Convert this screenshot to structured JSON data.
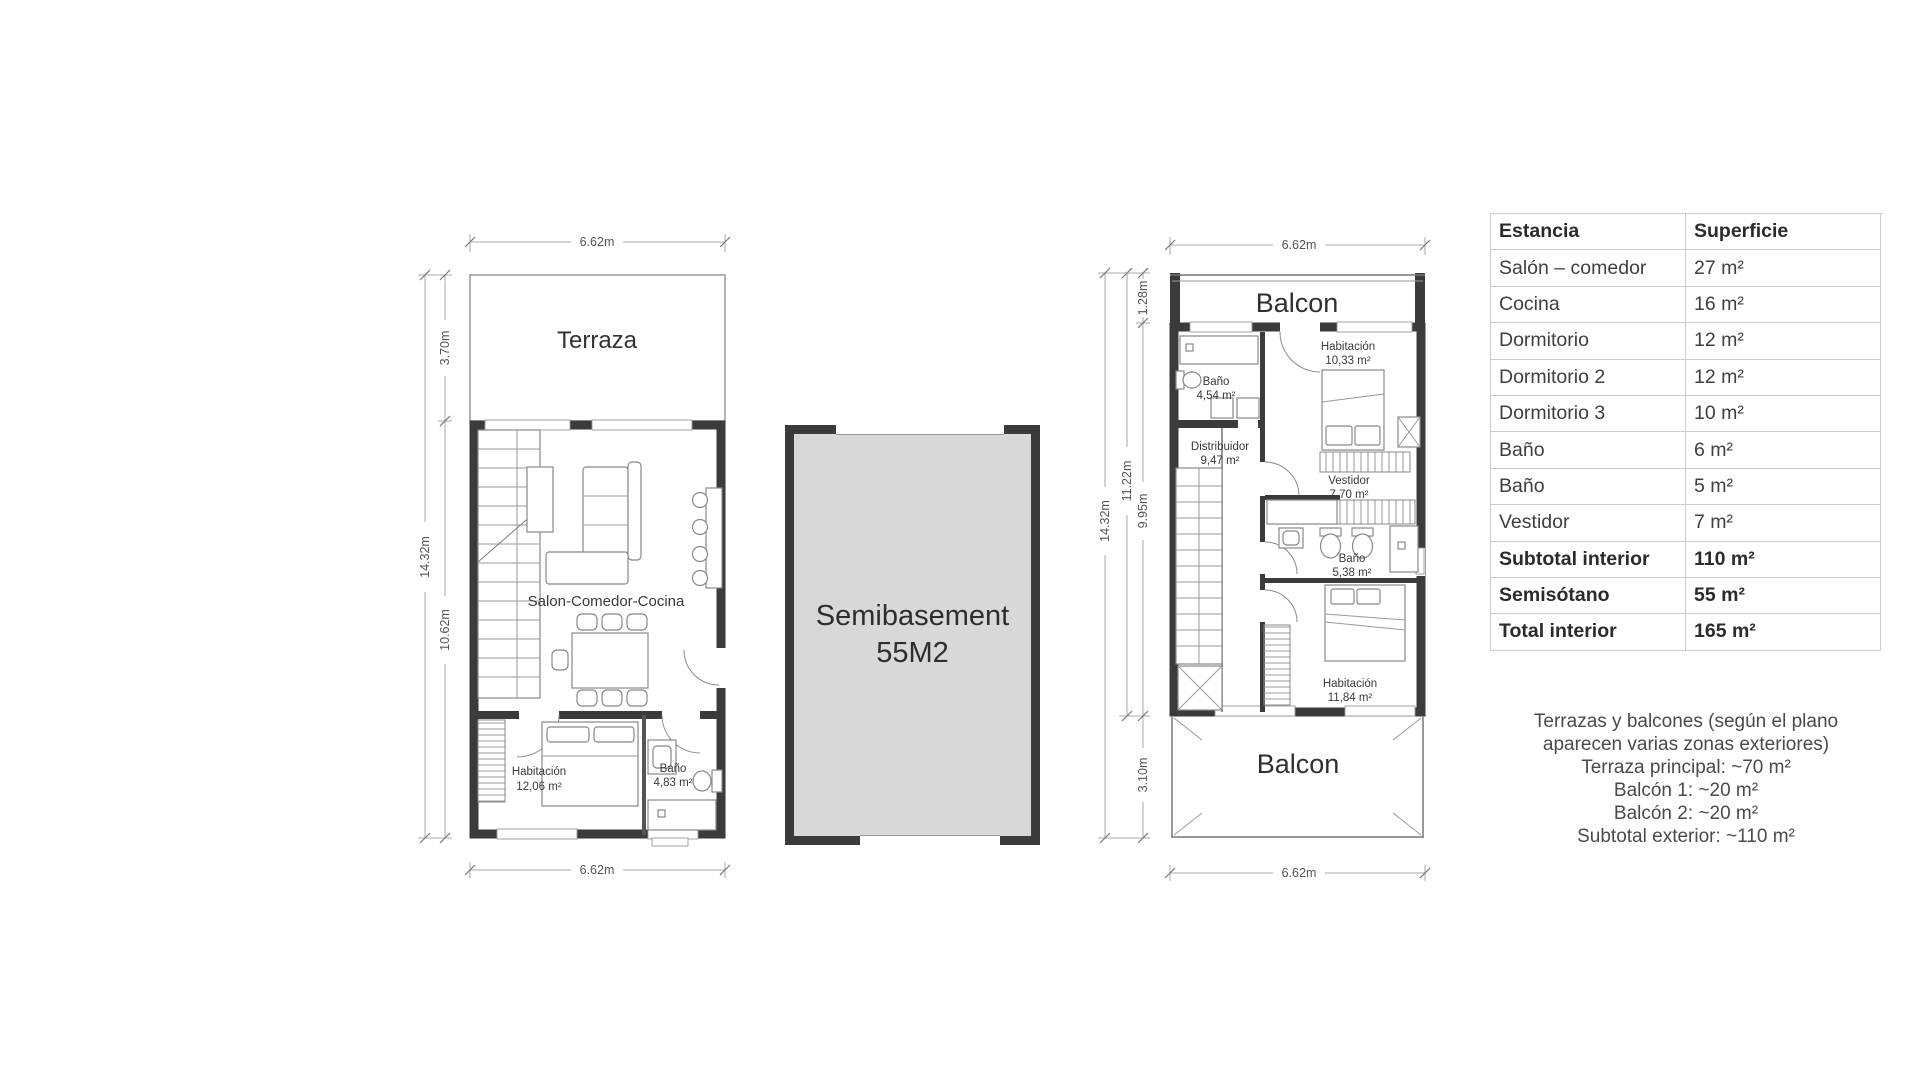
{
  "left_plan": {
    "dims": {
      "width_top": "6.62m",
      "width_bottom": "6.62m",
      "height_total": "14.32m",
      "height_terrace": "3.70m",
      "height_interior": "10.62m"
    },
    "rooms": {
      "terraza": "Terraza",
      "salon": "Salon-Comedor-Cocina",
      "habitacion_label": "Habitación",
      "habitacion_area": "12,06 m²",
      "bano_label": "Baño",
      "bano_area": "4,83 m²"
    }
  },
  "semibasement": {
    "line1": "Semibasement",
    "line2": "55M2"
  },
  "right_plan": {
    "dims": {
      "width_top": "6.62m",
      "width_bottom": "6.62m",
      "height_total": "14.32m",
      "height_upper": "11.22m",
      "height_balcon_top": "1.28m",
      "height_interior": "9.95m",
      "height_balcon_bottom": "3.10m"
    },
    "rooms": {
      "balcon_top": "Balcon",
      "bano1_label": "Baño",
      "bano1_area": "4,54 m²",
      "habitacion1_label": "Habitación",
      "habitacion1_area": "10,33 m²",
      "distribuidor_label": "Distribuidor",
      "distribuidor_area": "9,47 m²",
      "vestidor_label": "Vestidor",
      "vestidor_area": "7,70 m²",
      "bano2_label": "Baño",
      "bano2_area": "5,38 m²",
      "habitacion2_label": "Habitación",
      "habitacion2_area": "11,84 m²",
      "balcon_bottom": "Balcon"
    }
  },
  "table": {
    "headers": [
      "Estancia",
      "Superficie"
    ],
    "rows": [
      {
        "estancia": "Salón – comedor",
        "superficie": "27 m²"
      },
      {
        "estancia": "Cocina",
        "superficie": "16 m²"
      },
      {
        "estancia": "Dormitorio",
        "superficie": "12 m²"
      },
      {
        "estancia": "Dormitorio 2",
        "superficie": "12 m²"
      },
      {
        "estancia": "Dormitorio 3",
        "superficie": "10 m²"
      },
      {
        "estancia": "Baño",
        "superficie": "6 m²"
      },
      {
        "estancia": "Baño",
        "superficie": "5 m²"
      },
      {
        "estancia": "Vestidor",
        "superficie": "7 m²"
      },
      {
        "estancia": "Subtotal interior",
        "superficie": "110 m²"
      },
      {
        "estancia": "Semisótano",
        "superficie": "55 m²"
      },
      {
        "estancia": "Total interior",
        "superficie": "165 m²"
      }
    ]
  },
  "notes": {
    "lines": [
      "Terrazas y balcones (según el plano",
      "aparecen varias zonas exteriores)",
      "Terraza principal: ~70 m²",
      "Balcón 1: ~20 m²",
      "Balcón 2: ~20 m²",
      "Subtotal exterior: ~110 m²"
    ]
  },
  "colors": {
    "wall": "#3b3b3b",
    "line": "#888888",
    "dimension": "#aaaaaa",
    "semibasement_fill": "#d8d8d8",
    "table_border": "#cccccc",
    "text": "#3d3d3d"
  }
}
